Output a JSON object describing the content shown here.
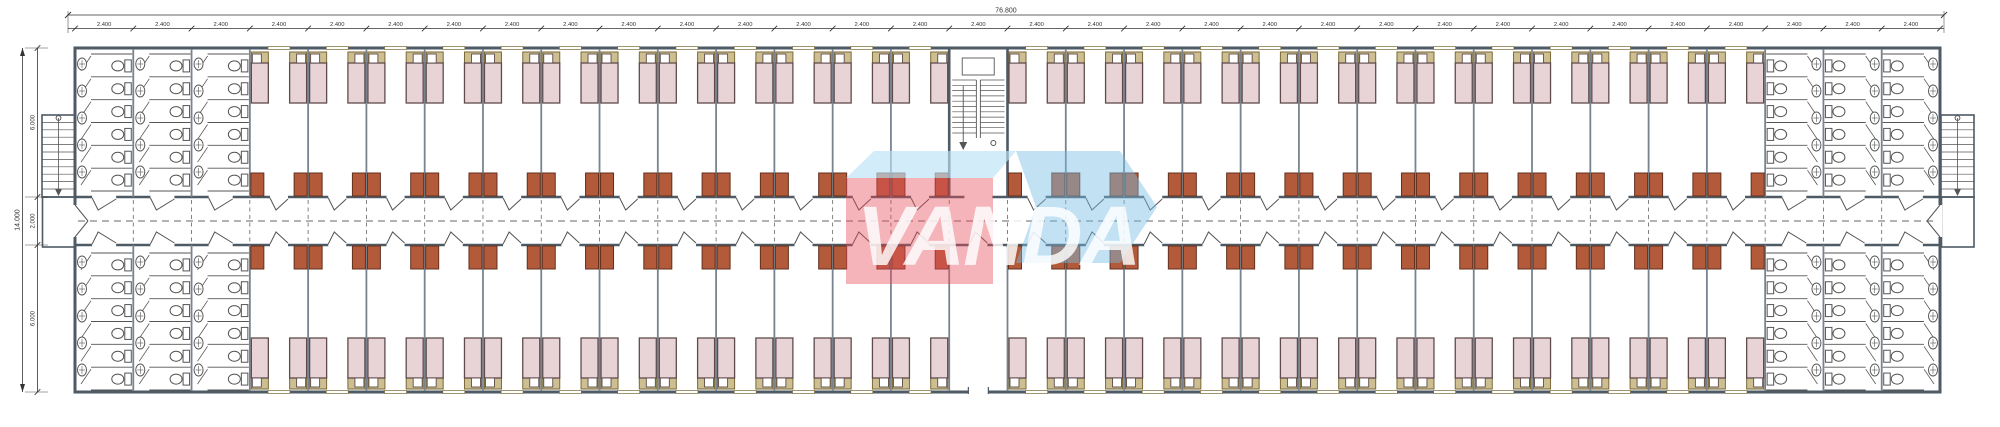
{
  "watermark": {
    "text": "VANDA"
  },
  "dimensions": {
    "top_total": "76.800",
    "module_label": "2.400",
    "module_count": 32,
    "left_total": "14.000",
    "left_segments": [
      "6.000",
      "2.000",
      "6.000"
    ]
  },
  "plan": {
    "type": "dormitory-floor-plan",
    "wings": 2,
    "rooms_per_wing": 25,
    "beds_per_room": 2,
    "sanitary_blocks": 4,
    "toilet_stalls_per_block": 18,
    "sinks_per_block": 15,
    "stairs": {
      "central": 1,
      "external": 2
    }
  },
  "colors": {
    "wall": "#4e5a64",
    "partition": "#77838f",
    "bed_fill": "#e8d4d7",
    "bed_border": "#5f4b4b",
    "headboard": "#cdbf92",
    "headboard_border": "#7a6a35",
    "pillow": "#ffffff",
    "wardrobe": "#b25a3a",
    "wardrobe_border": "#63301d",
    "fixture": "#555555",
    "dashed": "#666666",
    "dim": "#333333",
    "watermark_red": "rgba(231,76,90,0.42)",
    "watermark_blue": "rgba(120,191,231,0.45)",
    "watermark_lid": "rgba(186,226,247,0.65)",
    "watermark_text": "rgba(255,255,255,0.82)"
  }
}
